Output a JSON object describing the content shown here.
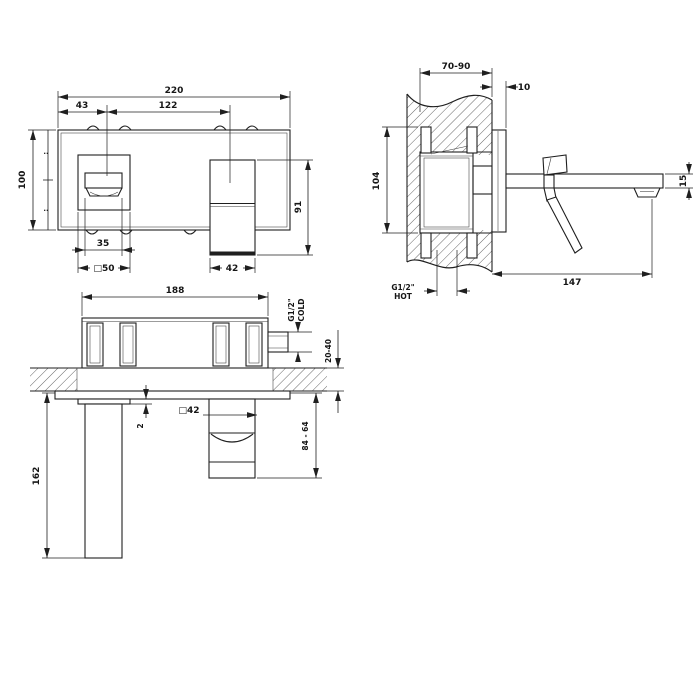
{
  "colors": {
    "line": "#1f1f1f",
    "hatch": "#555555",
    "background": "#ffffff"
  },
  "front_view": {
    "total_width": "220",
    "handle_center_offset": "43",
    "center_distance": "122",
    "plate_height": "100",
    "spout_height": "91",
    "handle_width": "35",
    "handle_plate": "□50",
    "spout_width": "42",
    "half_tick_upper": "··",
    "half_tick_lower": "··"
  },
  "side_view": {
    "recess_depth_range": "70-90",
    "plate_projection": "10",
    "body_height": "104",
    "spout_thickness": "15",
    "spout_projection": "147",
    "hot_inlet_size": "G1/2\"",
    "hot_inlet_label": "HOT"
  },
  "bottom_view": {
    "body_width": "188",
    "cold_inlet_size": "G1/2\"",
    "cold_inlet_label": "COLD",
    "finished_wall_range": "20-40",
    "plate_gap": "2",
    "spout_section": "□42",
    "spout_drop_range": "84 - 64",
    "lever_length": "162"
  }
}
